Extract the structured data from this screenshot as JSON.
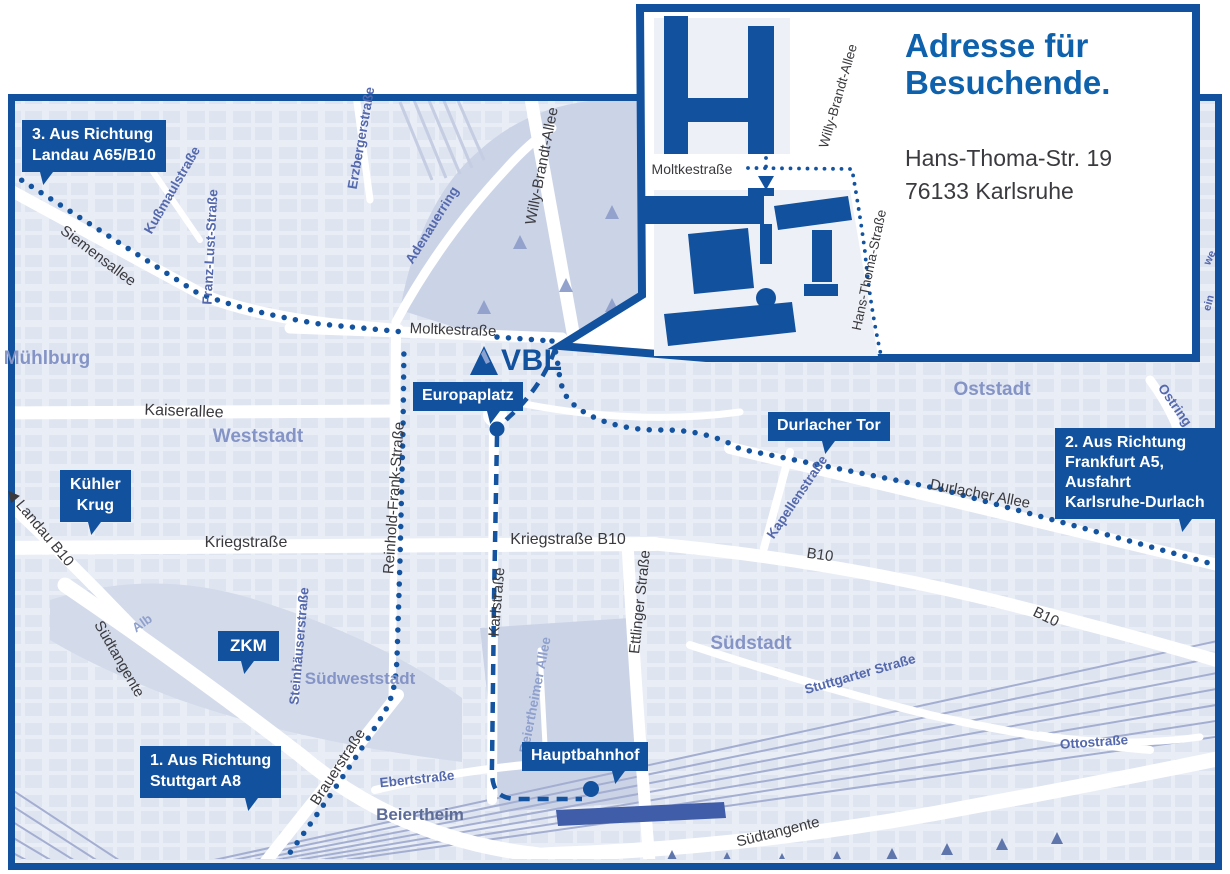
{
  "colors": {
    "brand_blue": "#11519e",
    "title_blue": "#0d61ad",
    "district_label": "#8594c6",
    "street_label_blue": "#5468ad",
    "street_label_dark": "#3a3a3e",
    "map_background": "#e9edf6"
  },
  "inset": {
    "title": "Adresse für Besuchende.",
    "address": {
      "line1": "Hans-Thoma-Str. 19",
      "line2": "76133 Karlsruhe"
    },
    "streets": {
      "moltkestrasse": "Moltkestraße",
      "willy_brandt_allee": "Willy-Brandt-Allee",
      "hans_thoma_strasse": "Hans-Thoma-Straße"
    }
  },
  "logo": {
    "vbl": "VBL"
  },
  "badges": {
    "route3": "3. Aus Richtung\nLandau A65/B10",
    "kuehler_krug": "Kühler\nKrug",
    "zkm": "ZKM",
    "route1": "1. Aus Richtung\nStuttgart A8",
    "europaplatz": "Europaplatz",
    "durlacher_tor": "Durlacher Tor",
    "route2": "2. Aus Richtung\nFrankfurt A5,\nAusfahrt\nKarlsruhe-Durlach",
    "hauptbahnhof": "Hauptbahnhof"
  },
  "map": {
    "districts": {
      "muehlburg": "Mühlburg",
      "weststadt": "Weststadt",
      "oststadt": "Oststadt",
      "suedstadt": "Südstadt",
      "suedweststadt": "Südweststadt",
      "beiertheim": "Beiertheim"
    },
    "streets": {
      "siemensallee": "Siemensallee",
      "kussmaulstrasse": "Kußmaulstraße",
      "franz_lust_strasse": "Franz-Lust-Straße",
      "erzbergerstrasse": "Erzbergerstraße",
      "adenauerring": "Adenauerring",
      "willy_brandt_allee": "Willy-Brandt-Allee",
      "moltkestrasse": "Moltkestraße",
      "kaiserallee": "Kaiserallee",
      "reinhold_frank_strasse": "Reinhold-Frank-Straße",
      "kriegstrasse": "Kriegstraße",
      "kriegstrasse_b10": "Kriegstraße B10",
      "landau_arrow": "◀",
      "landau_b10": "Landau B10",
      "karlstrasse": "Karlstraße",
      "ettlinger_strasse": "Ettlinger Straße",
      "kapellenstrasse": "Kapellenstraße",
      "durlacher_allee": "Durlacher Allee",
      "ostring": "Ostring",
      "b10_west": "B10",
      "b10_east": "B10",
      "stuttgarter_strasse": "Stuttgarter Straße",
      "steinhaeuserstrasse": "Steinhäuserstraße",
      "beiertheimer_allee": "Beiertheimer Allee",
      "ebertstrasse": "Ebertstraße",
      "brauerstrasse": "Brauerstraße",
      "suedtangente_west": "Südtangente",
      "suedtangente_sued": "Südtangente",
      "ottostrasse": "Ottostraße",
      "alb": "Alb",
      "fragment_we": "we",
      "fragment_ein": "ein"
    }
  }
}
